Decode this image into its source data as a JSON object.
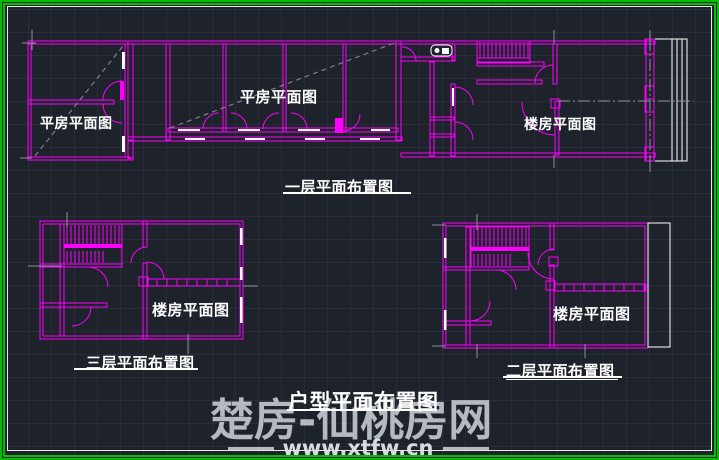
{
  "colors": {
    "background": "#1d222b",
    "grid": "#272e39",
    "frame_green": "#00bf00",
    "frame_white": "#e8e8e8",
    "plan_lines": "#ff00ff",
    "axis_lines": "#8b9199",
    "label_text": "#ffffff",
    "watermark": "#c6cbd3"
  },
  "drawing": {
    "strip": {
      "label_left": "平房平面图",
      "label_mid": "平房平面图",
      "label_right": "楼房平面图",
      "title": "一层平面布置图"
    },
    "floor3": {
      "label": "楼房平面图",
      "title": "三层平面布置图"
    },
    "floor2": {
      "label": "楼房平面图",
      "title": "二层平面布置图"
    },
    "main_title": "户型平面布置图"
  },
  "watermark": {
    "site_name": "楚房-仙桃房网",
    "site_url": "www.xtfw.cn"
  }
}
